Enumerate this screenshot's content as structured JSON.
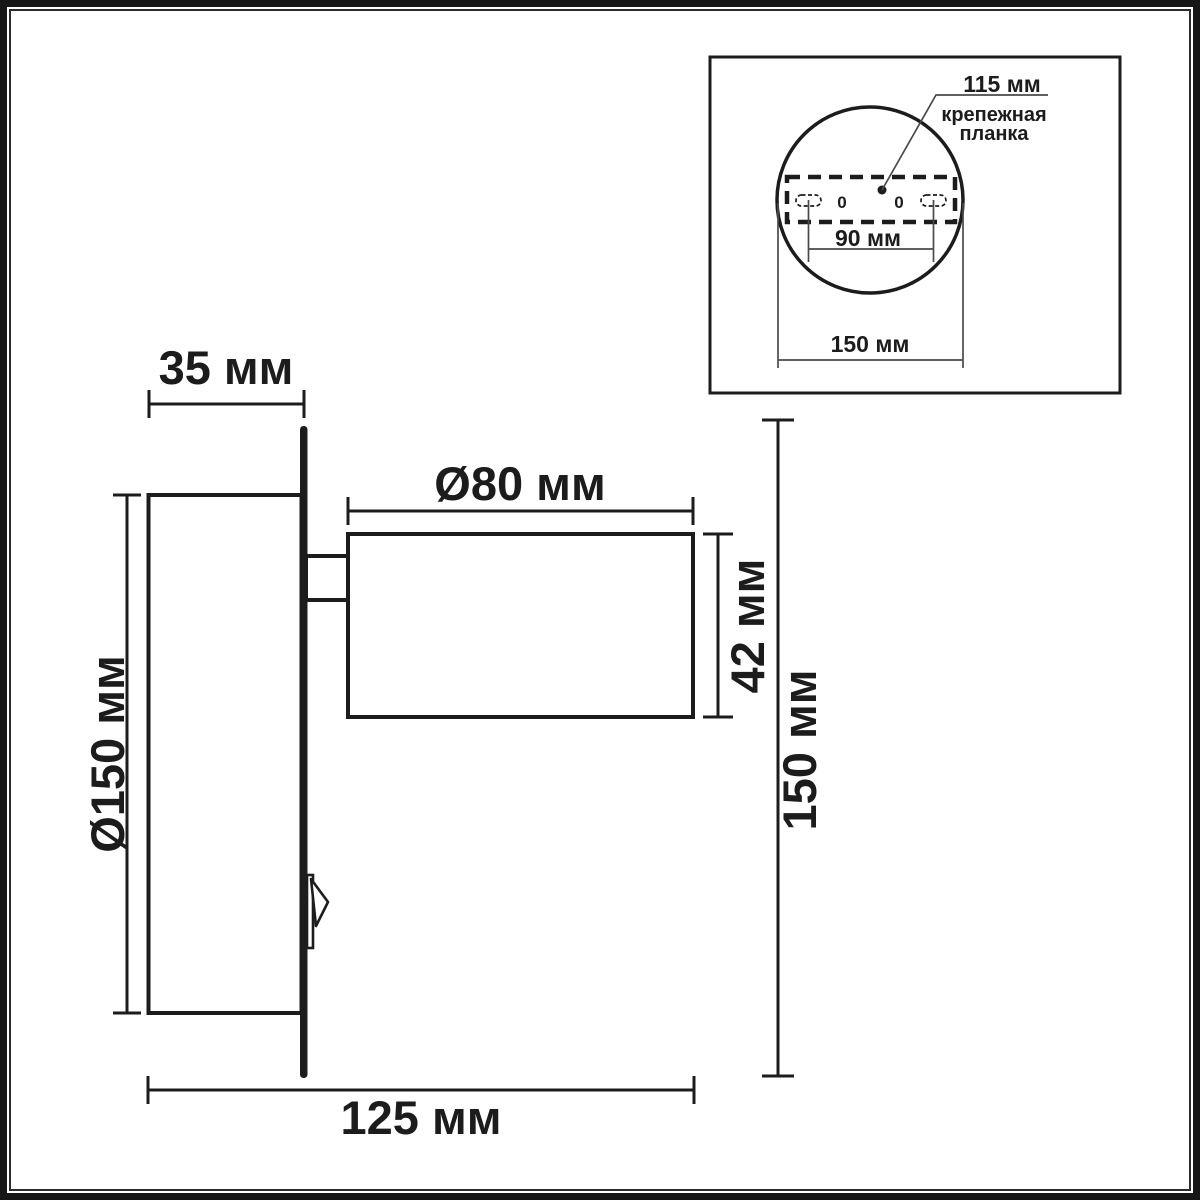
{
  "drawing": {
    "kind": "wall-lamp dimensional drawing",
    "background": "#ffffff",
    "line_color": "#1c1c1c",
    "thin_line_color": "#4a4a4a"
  },
  "side_view": {
    "base_depth": "35 мм",
    "head_diameter": "Ø80 мм",
    "head_height": "42 мм",
    "base_diameter": "Ø150 мм",
    "overall_height": "150 мм",
    "overall_projection": "125 мм"
  },
  "inset": {
    "plate_width": "115 мм",
    "plate_caption_line1": "крепежная",
    "plate_caption_line2": "планка",
    "hole_spacing": "90 мм",
    "base_diameter": "150 мм",
    "hole_marks": [
      "0",
      "0"
    ]
  }
}
